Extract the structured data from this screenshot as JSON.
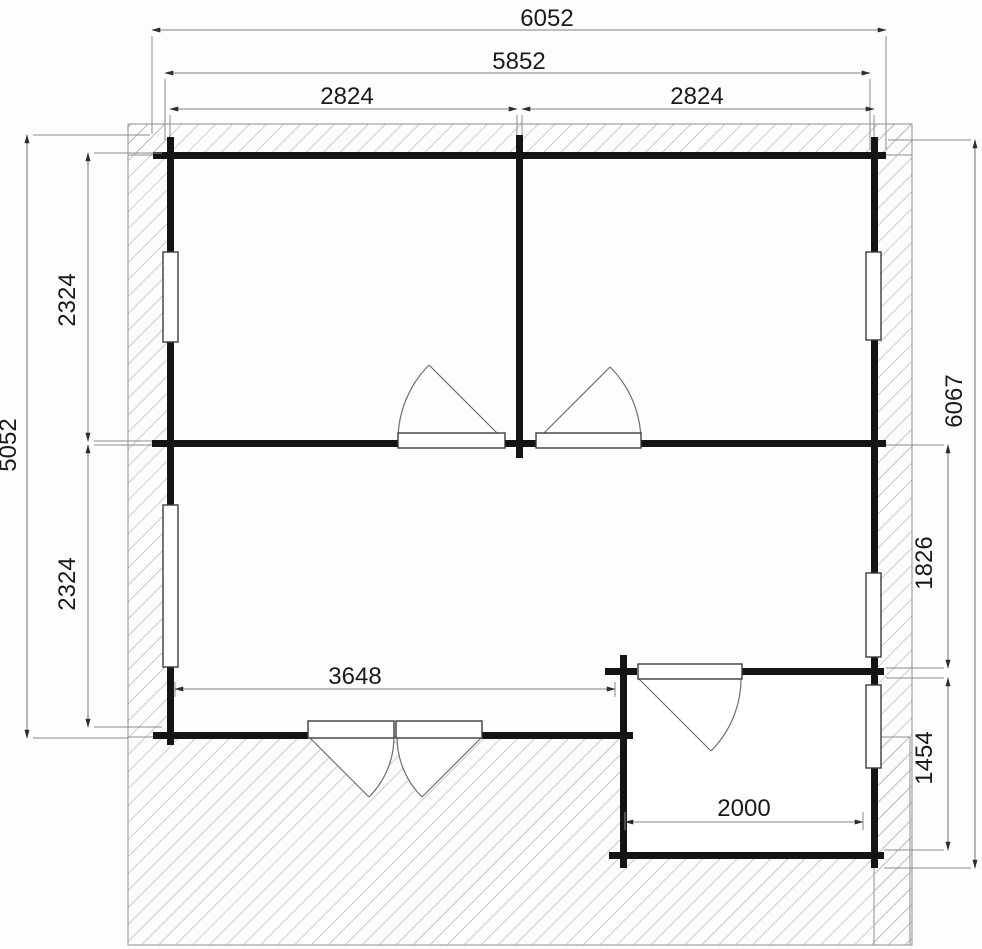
{
  "drawing": {
    "dims": {
      "top_total": "6052",
      "top_shell": "5852",
      "top_left_room": "2824",
      "top_right_room": "2824",
      "left_total": "5052",
      "left_upper_room": "2324",
      "left_lower_room": "2324",
      "right_total": "6067",
      "right_mid_room": "1826",
      "right_annex": "1454",
      "bottom_room": "3648",
      "annex_width": "2000"
    }
  }
}
